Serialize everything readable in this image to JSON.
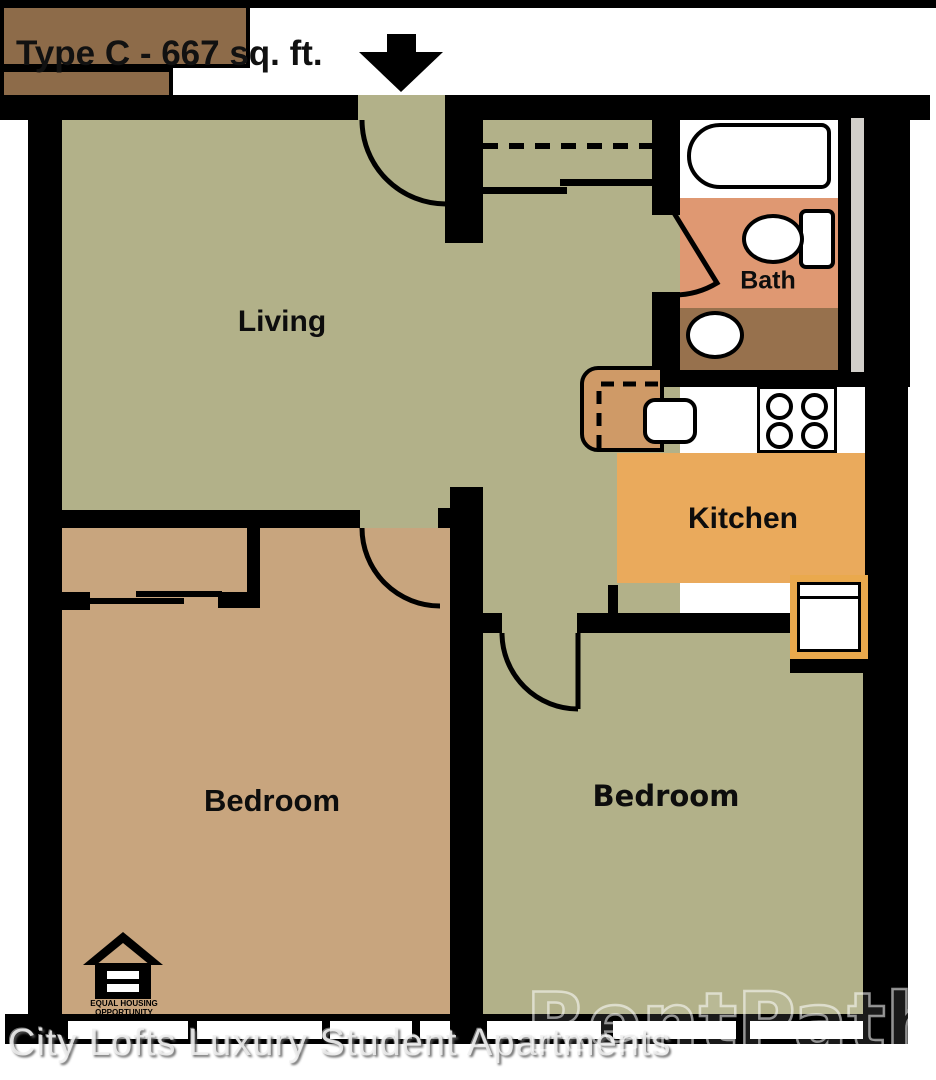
{
  "header": {
    "title": "Type C - 667 sq. ft.",
    "arrow_icon": "down-arrow-icon"
  },
  "rooms": {
    "living": {
      "label": "Living"
    },
    "bath": {
      "label": "Bath"
    },
    "kitchen": {
      "label": "Kitchen"
    },
    "bedroom_left": {
      "label": "Bedroom"
    },
    "bedroom_right": {
      "label": "Bedroom"
    }
  },
  "fixtures": {
    "bathtub": "bathtub-icon",
    "toilet": "toilet-icon",
    "bath_sink": "bath-sink-icon",
    "kitchen_sink": "kitchen-sink-icon",
    "stove": "stove-icon",
    "refrigerator": "refrigerator-icon",
    "breakfast_bar": "breakfast-bar-icon",
    "closet_rod": "closet-rod-dashed-line",
    "sliding_doors": "sliding-door-icon",
    "door_swings": "door-swing-arc-icon"
  },
  "footer": {
    "eho_line1": "EQUAL HOUSING",
    "eho_line2": "OPPORTUNITY",
    "watermark_text": "City Lofts Luxury Student Apartments",
    "brand_watermark": "RentPath",
    "registered_mark": "®"
  },
  "colors": {
    "wall": "#000000",
    "living_floor": "#b2b189",
    "bedroom_left_floor": "#c8a57e",
    "bedroom_right_floor": "#b2b189",
    "bath_floor": "#df9872",
    "vanity_counter": "#97714d",
    "kitchen_floor": "#eaaa5c",
    "kitchen_counter": "#8d6b49",
    "breakfast_bar": "#cf9a67",
    "fridge_trim": "#eaa94d",
    "plumbing_chase": "#d2cfca"
  }
}
